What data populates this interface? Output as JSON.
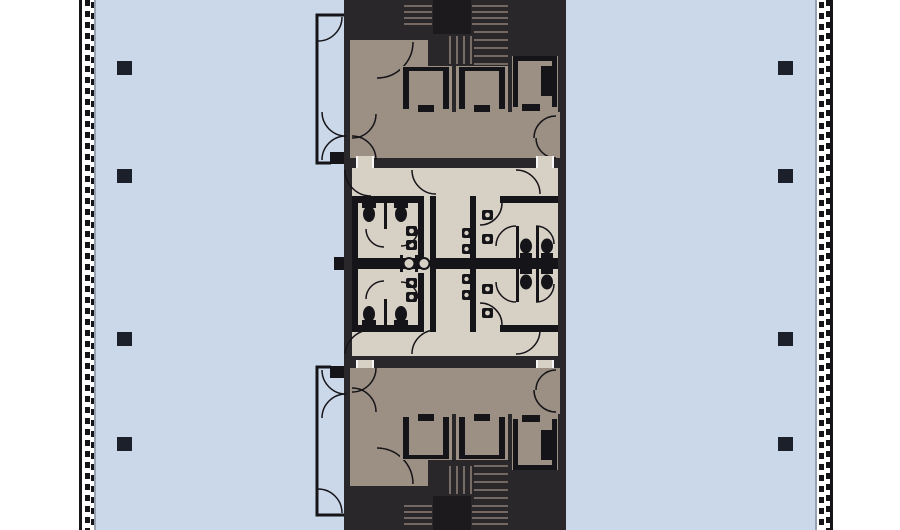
{
  "plan": {
    "kind": "architectural floor plan",
    "regions": {
      "office": "open office area",
      "facade": "curtain wall facade",
      "core": "central service core",
      "lobby": "elevator lobby",
      "elevators": "elevator cabs",
      "stairs": "exit stairs",
      "restrooms": "restroom block",
      "columns": "structural columns"
    },
    "counts": {
      "columns": 8,
      "elevator_cabs": 6,
      "stairs": 2,
      "restrooms": 2
    }
  },
  "colors": {
    "background": "#ffffff",
    "floor": "#cbd8e9",
    "core_dark": "#2a272a",
    "core_darker": "#1d1a1d",
    "lobby_taupe": "#9c8f84",
    "stair_tread": "#8b7f75",
    "restroom_beige": "#d6d0c5",
    "wall_dark": "#151418",
    "column": "#1b202a",
    "gray_line": "#96a0ae"
  }
}
